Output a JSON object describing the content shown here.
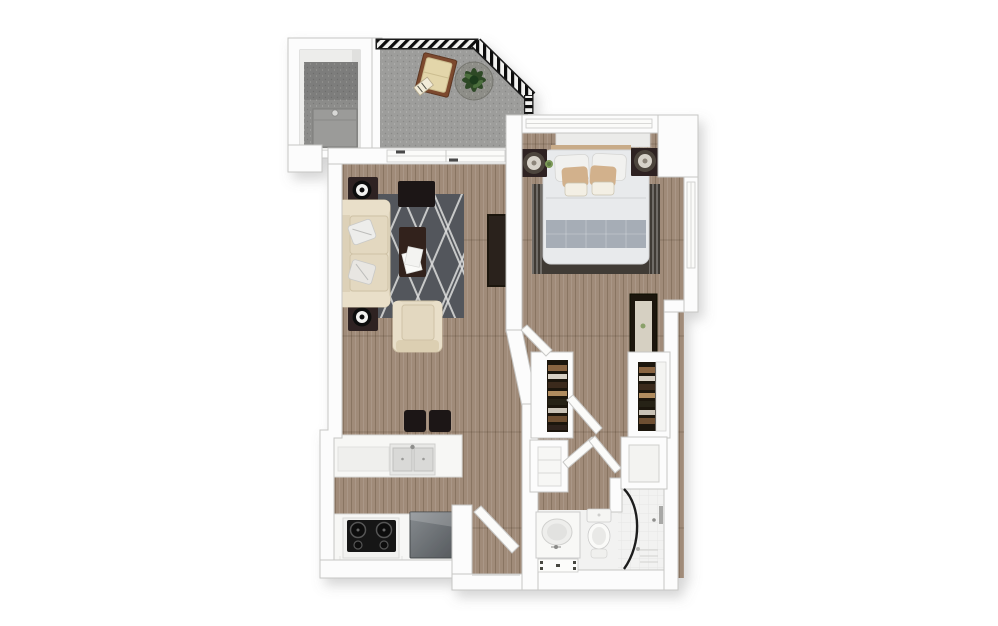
{
  "canvas": {
    "width": 998,
    "height": 626,
    "background": "#ffffff"
  },
  "palette": {
    "background": "#ffffff",
    "wall_fill": "#fcfcfc",
    "wall_stroke": "#c6c6c4",
    "wood": "#a08b79",
    "wood_line": "rgba(84,62,45,0.30)",
    "balcony_floor": "#9d9d9b",
    "carpet": "#8c8c8a",
    "railing_dark": "#1a1a1a",
    "rug_living": "#53575b",
    "rug_line": "#dcdcdc",
    "rug_bedroom": "#413b34",
    "sofa": "#e6dcc6",
    "sofa_shade": "#cfc2a6",
    "cushion": "#e3d8c0",
    "dark_wood": "#2e2420",
    "espresso": "#1f1815",
    "mattress": "#e8eaec",
    "blanket": "#a6adb6",
    "pillow_tan": "#d2b18c",
    "headboard_tan": "#c8ab88",
    "headboard_white": "#ebebe9",
    "counter": "#f7f7f5",
    "cooktop": "#161616",
    "stainless_light": "#868b8f",
    "stainless_dark": "#565a5e",
    "bath_floor": "#f2f2f1",
    "fixture": "#f8f8f6",
    "fixture_stroke": "#cccccc",
    "glass": "#1d1d1d",
    "closet_dark": "#1d150e",
    "leaf": "#2d4a27",
    "planter": "#8e8e88",
    "chair_wood": "#7c4a2d",
    "chair_cushion": "#e3d6aa"
  },
  "plan": {
    "type": "apartment-floor-plan-3d-top-view",
    "rooms": [
      {
        "id": "balcony",
        "furniture": [
          "railing",
          "lounge-chair",
          "potted-plant"
        ]
      },
      {
        "id": "utility-room",
        "furniture": [
          "washer-unit"
        ]
      },
      {
        "id": "living-room",
        "furniture": [
          "sofa",
          "throw-pillows",
          "side-table-top",
          "side-table-bottom",
          "decor-bowl",
          "media-bench",
          "coffee-table",
          "papers",
          "armchair",
          "area-rug",
          "tv-console",
          "wall-frames",
          "sliding-glass-door"
        ]
      },
      {
        "id": "bedroom",
        "furniture": [
          "bed",
          "headboard",
          "pillows",
          "blanket",
          "area-rug",
          "nightstand-left",
          "nightstand-right",
          "lamp-left",
          "lamp-right",
          "small-plant",
          "dresser-mirror",
          "window-top",
          "window-right"
        ]
      },
      {
        "id": "kitchen",
        "furniture": [
          "peninsula-counter",
          "double-sink",
          "bar-stool-left",
          "bar-stool-right",
          "base-counter",
          "stove-cooktop",
          "refrigerator"
        ]
      },
      {
        "id": "hallway",
        "furniture": [
          "closet-left",
          "closet-right",
          "linen-shelf-left",
          "linen-shelf-right",
          "bedroom-door",
          "closet-doors"
        ]
      },
      {
        "id": "entry",
        "furniture": [
          "entry-door"
        ]
      },
      {
        "id": "bathroom",
        "furniture": [
          "vanity-sink",
          "faucet",
          "bath-mat",
          "toilet",
          "curved-glass-shower",
          "shower-drain",
          "shower-fixture"
        ]
      }
    ]
  }
}
